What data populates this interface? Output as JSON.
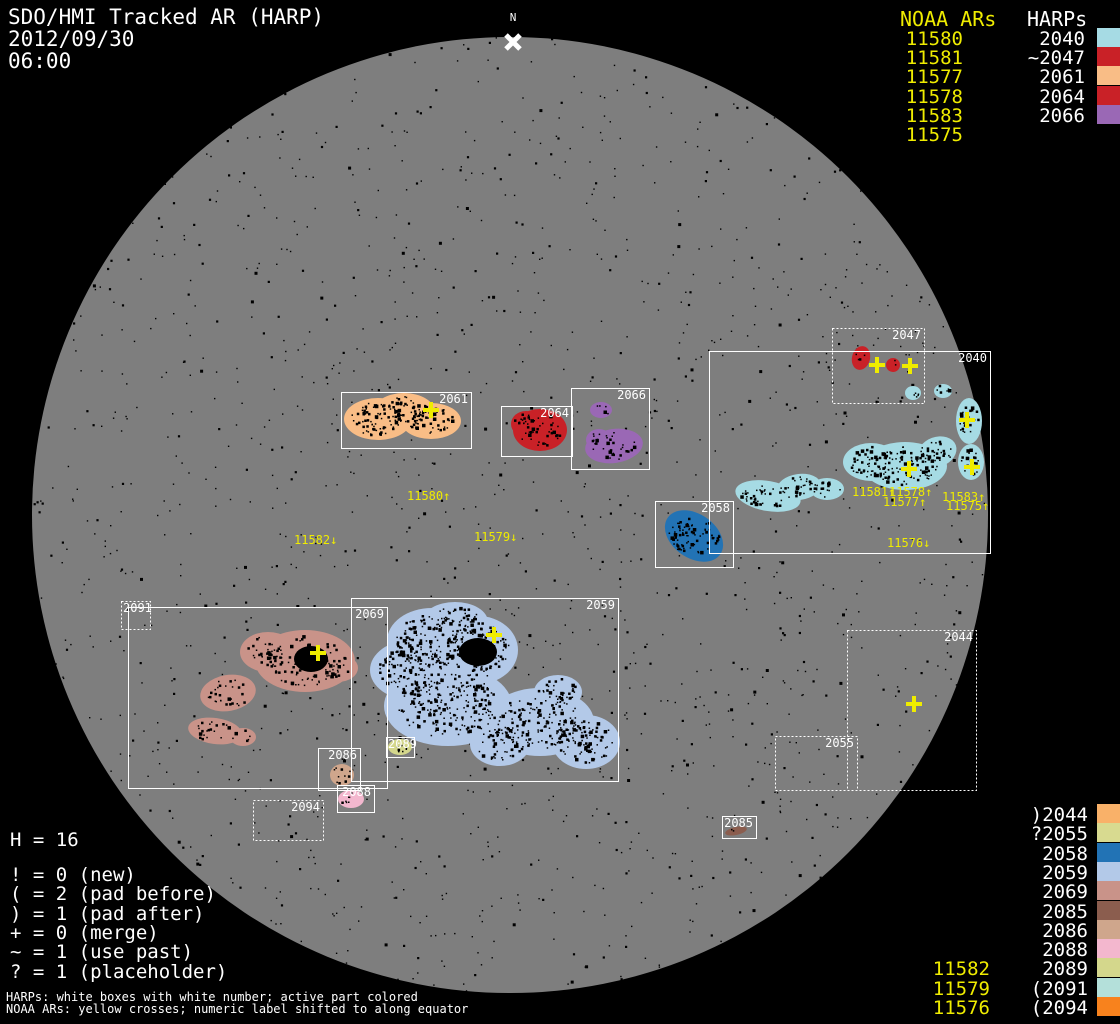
{
  "header": {
    "title": "SDO/HMI Tracked AR (HARP)",
    "date": "2012/09/30",
    "time": "06:00"
  },
  "north_marker": {
    "label": "N"
  },
  "colors": {
    "background": "#000000",
    "disk": "#7e7e7e",
    "yellow": "#efec00",
    "white": "#ffffff"
  },
  "top_right_legend": {
    "noaa_header": "NOAA ARs",
    "harps_header": "HARPs",
    "noaa_items": [
      "11580",
      "11581",
      "11577",
      "11578",
      "11583",
      "11575"
    ],
    "harp_items": [
      {
        "label": "2040",
        "color": "#a6dbe4"
      },
      {
        "label": "~2047",
        "color": "#c92127"
      },
      {
        "label": "2061",
        "color": "#f9bd86"
      },
      {
        "label": "2064",
        "color": "#c92127"
      },
      {
        "label": "2066",
        "color": "#9a68b5"
      }
    ]
  },
  "bottom_left": {
    "harp_count": "H = 16",
    "legend_lines": [
      "! = 0 (new)",
      "( = 2 (pad before)",
      ") = 1 (pad after)",
      "+ = 0 (merge)",
      "~ = 1 (use past)",
      "? = 1 (placeholder)"
    ],
    "footnote1": "HARPs: white boxes with white number; active part colored",
    "footnote2": "NOAA ARs: yellow crosses; numeric label shifted to along equator"
  },
  "bottom_right": {
    "rows": [
      {
        "label": ")2044",
        "color": "#f9b169"
      },
      {
        "label": "?2055",
        "color": "#d8da90"
      },
      {
        "label": "2058",
        "color": "#2273b5"
      },
      {
        "label": "2059",
        "color": "#b3c9e8"
      },
      {
        "label": "2069",
        "color": "#c99389"
      },
      {
        "label": "2085",
        "color": "#8b5d4e"
      },
      {
        "label": "2086",
        "color": "#cfa68c"
      },
      {
        "label": "2088",
        "color": "#f3b7ce"
      },
      {
        "label": "2089",
        "color": "#d4d78c"
      },
      {
        "label": "(2091",
        "color": "#b4e0da"
      },
      {
        "label": "(2094",
        "color": "#f8821d"
      }
    ],
    "noaa_labels": [
      "11582",
      "11579",
      "11576"
    ]
  },
  "chart_data": {
    "type": "scatter",
    "title": "SDO/HMI Tracked AR (HARP) 2012/09/30 06:00",
    "disk": {
      "cx": 510,
      "cy": 515,
      "r": 478
    },
    "regions": [
      {
        "id": "2061",
        "label": "2061",
        "box": [
          341,
          392,
          130,
          56
        ],
        "dotted": false,
        "color": "#f9bd86",
        "blobs": [
          [
            378,
            419,
            34,
            21,
            0
          ],
          [
            431,
            421,
            30,
            18,
            0
          ],
          [
            404,
            412,
            31,
            19,
            0
          ]
        ],
        "cores": [],
        "crosses": [
          [
            431,
            410
          ]
        ],
        "speckle": 1.7
      },
      {
        "id": "2064",
        "label": "2064",
        "box": [
          501,
          406,
          71,
          50
        ],
        "dotted": false,
        "color": "#c92127",
        "blobs": [
          [
            540,
            430,
            27,
            21,
            0
          ],
          [
            526,
            424,
            15,
            13,
            0
          ]
        ],
        "cores": [],
        "crosses": [],
        "speckle": 1.2
      },
      {
        "id": "2066",
        "label": "2066",
        "box": [
          571,
          388,
          78,
          81
        ],
        "dotted": false,
        "color": "#9a68b5",
        "blobs": [
          [
            601,
            410,
            11,
            8,
            0
          ],
          [
            614,
            446,
            29,
            17,
            -8
          ],
          [
            599,
            440,
            13,
            11,
            0
          ]
        ],
        "cores": [],
        "crosses": [],
        "speckle": 1.0
      },
      {
        "id": "2047",
        "label": "2047",
        "box": [
          832,
          328,
          92,
          75
        ],
        "dotted": true,
        "color": "#c92127",
        "blobs": [
          [
            861,
            358,
            9,
            12,
            15
          ],
          [
            893,
            365,
            7,
            7,
            0
          ]
        ],
        "cores": [],
        "crosses": [
          [
            877,
            365
          ],
          [
            910,
            366
          ]
        ],
        "speckle": 0.6
      },
      {
        "id": "2040",
        "label": "2040",
        "box": [
          709,
          351,
          281,
          202
        ],
        "dotted": false,
        "color": "#a6dbe4",
        "blobs": [
          [
            768,
            496,
            33,
            15,
            10
          ],
          [
            799,
            487,
            22,
            13,
            -8
          ],
          [
            827,
            489,
            17,
            11,
            0
          ],
          [
            871,
            462,
            28,
            19,
            0
          ],
          [
            905,
            466,
            42,
            24,
            0
          ],
          [
            937,
            452,
            20,
            15,
            -20
          ],
          [
            913,
            393,
            8,
            7,
            0
          ],
          [
            943,
            391,
            9,
            7,
            0
          ],
          [
            969,
            421,
            13,
            23,
            0
          ],
          [
            971,
            462,
            13,
            18,
            0
          ]
        ],
        "cores": [],
        "crosses": [
          [
            967,
            420
          ],
          [
            909,
            469
          ],
          [
            972,
            467
          ]
        ],
        "speckle": 1.7
      },
      {
        "id": "2058",
        "label": "2058",
        "box": [
          655,
          501,
          78,
          66
        ],
        "dotted": false,
        "color": "#2273b5",
        "blobs": [
          [
            694,
            536,
            32,
            22,
            35
          ]
        ],
        "cores": [],
        "crosses": [],
        "speckle": 2.0
      },
      {
        "id": "2059",
        "label": "2059",
        "box": [
          351,
          598,
          267,
          183
        ],
        "dotted": false,
        "color": "#b3c9e8",
        "blobs": [
          [
            432,
            641,
            45,
            33,
            0
          ],
          [
            478,
            650,
            40,
            34,
            0
          ],
          [
            455,
            622,
            33,
            20,
            0
          ],
          [
            412,
            670,
            42,
            30,
            0
          ],
          [
            448,
            706,
            64,
            40,
            0
          ],
          [
            540,
            722,
            54,
            34,
            0
          ],
          [
            586,
            742,
            34,
            27,
            0
          ],
          [
            500,
            744,
            30,
            22,
            0
          ],
          [
            558,
            692,
            24,
            17,
            0
          ]
        ],
        "cores": [
          [
            478,
            652,
            19,
            14,
            0
          ]
        ],
        "crosses": [
          [
            494,
            635
          ]
        ],
        "speckle": 1.5
      },
      {
        "id": "2069",
        "label": "2069",
        "box": [
          128,
          607,
          259,
          181
        ],
        "dotted": false,
        "color": "#c99389",
        "blobs": [
          [
            305,
            661,
            50,
            31,
            0
          ],
          [
            268,
            652,
            28,
            20,
            0
          ],
          [
            338,
            668,
            20,
            14,
            0
          ],
          [
            228,
            693,
            28,
            18,
            -10
          ],
          [
            215,
            731,
            27,
            13,
            8
          ],
          [
            243,
            737,
            13,
            9,
            0
          ]
        ],
        "cores": [
          [
            311,
            659,
            17,
            13,
            0
          ]
        ],
        "crosses": [
          [
            318,
            653
          ]
        ],
        "speckle": 1.0
      },
      {
        "id": "2089",
        "label": "2089",
        "box": [
          386,
          737,
          28,
          20
        ],
        "dotted": false,
        "color": "#d4d78c",
        "blobs": [
          [
            400,
            747,
            12,
            8,
            0
          ]
        ],
        "cores": [],
        "crosses": [],
        "speckle": 1.5,
        "label_pos": "tl"
      },
      {
        "id": "2086",
        "label": "2086",
        "box": [
          318,
          748,
          42,
          42
        ],
        "dotted": false,
        "color": "#cfa68c",
        "blobs": [
          [
            342,
            775,
            12,
            11,
            0
          ]
        ],
        "cores": [],
        "crosses": [],
        "speckle": 1.5
      },
      {
        "id": "2088",
        "label": "2088",
        "box": [
          337,
          785,
          37,
          27
        ],
        "dotted": false,
        "color": "#f3b7ce",
        "blobs": [
          [
            351,
            799,
            13,
            9,
            0
          ]
        ],
        "cores": [],
        "crosses": [],
        "speckle": 1.0
      },
      {
        "id": "2085",
        "label": "2085",
        "box": [
          722,
          816,
          34,
          22
        ],
        "dotted": false,
        "color": "#8b5d4e",
        "blobs": [
          [
            736,
            831,
            11,
            4,
            -12
          ]
        ],
        "cores": [],
        "crosses": [],
        "speckle": 1.0
      },
      {
        "id": "2091",
        "label": "2091",
        "box": [
          121,
          601,
          29,
          28
        ],
        "dotted": true,
        "color": null,
        "blobs": [],
        "cores": [],
        "crosses": [],
        "label_pos": "tl"
      },
      {
        "id": "2094",
        "label": "2094",
        "box": [
          253,
          800,
          70,
          40
        ],
        "dotted": true,
        "color": null,
        "blobs": [],
        "cores": [],
        "crosses": []
      },
      {
        "id": "2044",
        "label": "2044",
        "box": [
          847,
          630,
          129,
          160
        ],
        "dotted": true,
        "color": null,
        "blobs": [],
        "cores": [],
        "crosses": [
          [
            914,
            704
          ]
        ]
      },
      {
        "id": "2055",
        "label": "2055",
        "box": [
          775,
          736,
          82,
          54
        ],
        "dotted": true,
        "color": null,
        "blobs": [],
        "cores": [],
        "crosses": []
      }
    ],
    "equator_labels": [
      {
        "text": "11580↑",
        "x": 407,
        "y": 491
      },
      {
        "text": "11582↓",
        "x": 294,
        "y": 535
      },
      {
        "text": "11579↓",
        "x": 474,
        "y": 532
      },
      {
        "text": "11581↑",
        "x": 852,
        "y": 487
      },
      {
        "text": "11578↑",
        "x": 889,
        "y": 487
      },
      {
        "text": "11577↑",
        "x": 883,
        "y": 497
      },
      {
        "text": "11583↑",
        "x": 942,
        "y": 492
      },
      {
        "text": "11575↑",
        "x": 946,
        "y": 501
      },
      {
        "text": "11576↓",
        "x": 887,
        "y": 538
      }
    ]
  }
}
